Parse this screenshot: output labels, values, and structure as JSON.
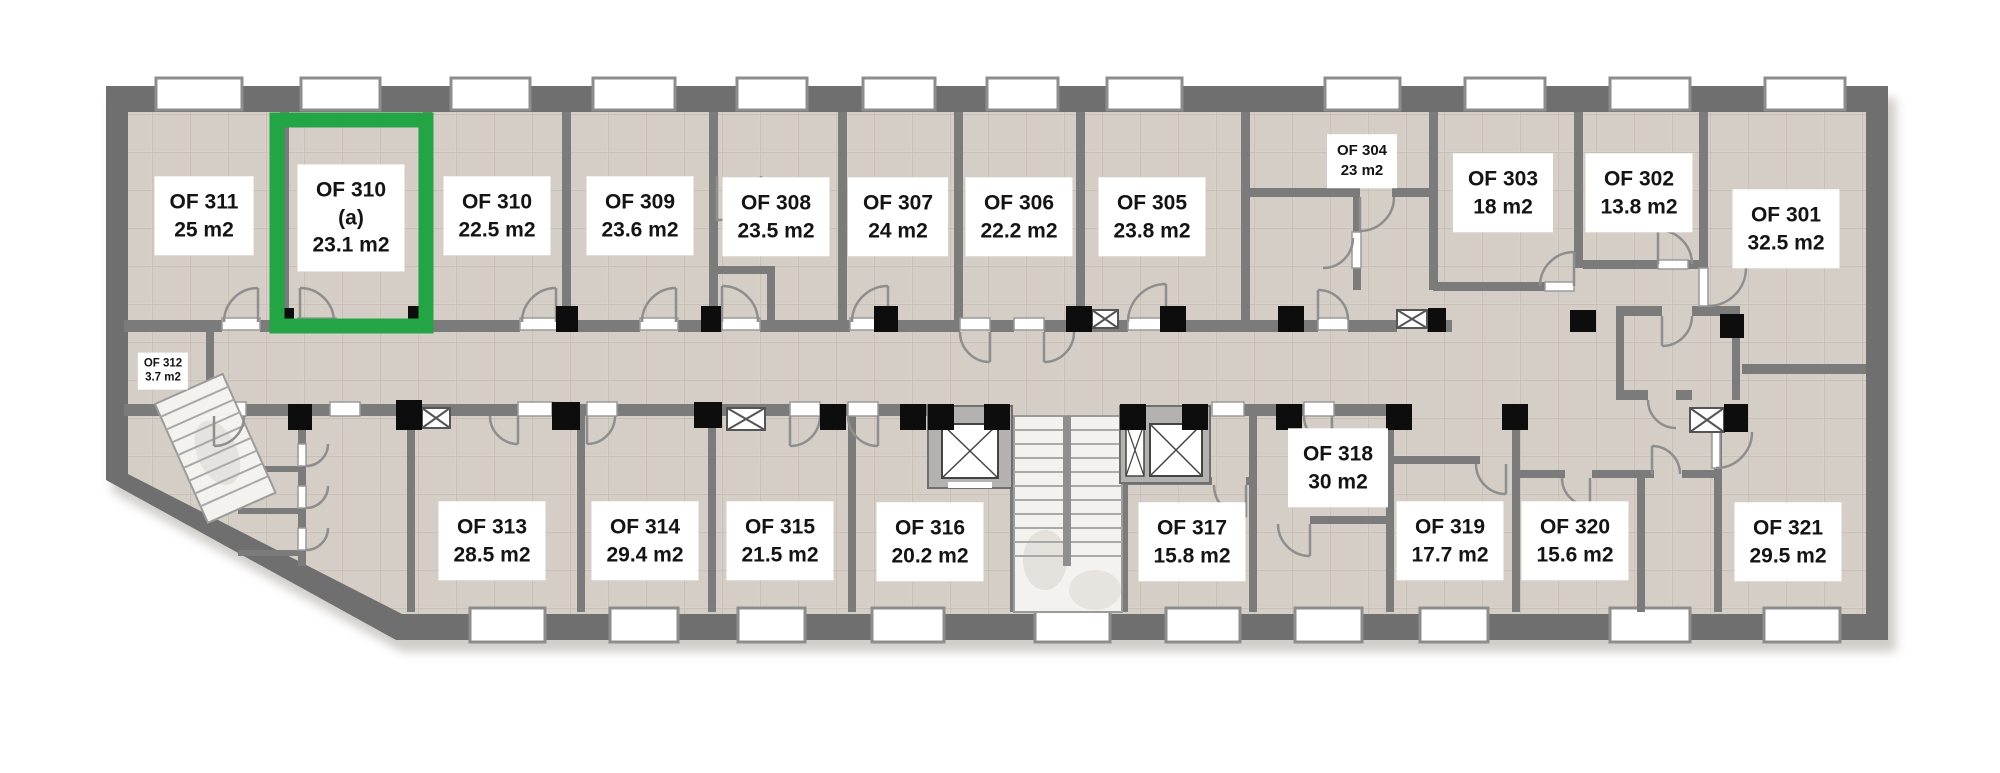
{
  "floorplan": {
    "highlighted_room": "OF 310 (a)",
    "colors": {
      "highlight_green": "#23a546",
      "wall_gray": "#6f6f6f",
      "floor_tile": "#d8d1c9",
      "column_black": "#0d0d0d",
      "label_background": "#ffffff",
      "label_text": "#141414"
    },
    "rooms": [
      {
        "id": "of-311",
        "name": "OF 311",
        "area": "25 m2"
      },
      {
        "id": "of-310-a",
        "name": "OF 310",
        "sub": "(a)",
        "area": "23.1 m2",
        "selected": true
      },
      {
        "id": "of-310",
        "name": "OF 310",
        "area": "22.5 m2"
      },
      {
        "id": "of-309",
        "name": "OF 309",
        "area": "23.6 m2"
      },
      {
        "id": "of-308",
        "name": "OF 308",
        "area": "23.5 m2"
      },
      {
        "id": "of-307",
        "name": "OF 307",
        "area": "24 m2"
      },
      {
        "id": "of-306",
        "name": "OF 306",
        "area": "22.2 m2"
      },
      {
        "id": "of-305",
        "name": "OF 305",
        "area": "23.8 m2"
      },
      {
        "id": "of-304",
        "name": "OF 304",
        "area": "23 m2"
      },
      {
        "id": "of-303",
        "name": "OF 303",
        "area": "18 m2"
      },
      {
        "id": "of-302",
        "name": "OF 302",
        "area": "13.8 m2"
      },
      {
        "id": "of-301",
        "name": "OF 301",
        "area": "32.5 m2"
      },
      {
        "id": "of-312",
        "name": "OF 312",
        "area": "3.7 m2"
      },
      {
        "id": "of-313",
        "name": "OF 313",
        "area": "28.5 m2"
      },
      {
        "id": "of-314",
        "name": "OF 314",
        "area": "29.4 m2"
      },
      {
        "id": "of-315",
        "name": "OF 315",
        "area": "21.5 m2"
      },
      {
        "id": "of-316",
        "name": "OF 316",
        "area": "20.2 m2"
      },
      {
        "id": "of-317",
        "name": "OF 317",
        "area": "15.8 m2"
      },
      {
        "id": "of-318",
        "name": "OF 318",
        "area": "30 m2"
      },
      {
        "id": "of-319",
        "name": "OF 319",
        "area": "17.7 m2"
      },
      {
        "id": "of-320",
        "name": "OF 320",
        "area": "15.6 m2"
      },
      {
        "id": "of-321",
        "name": "OF 321",
        "area": "29.5 m2"
      }
    ]
  }
}
